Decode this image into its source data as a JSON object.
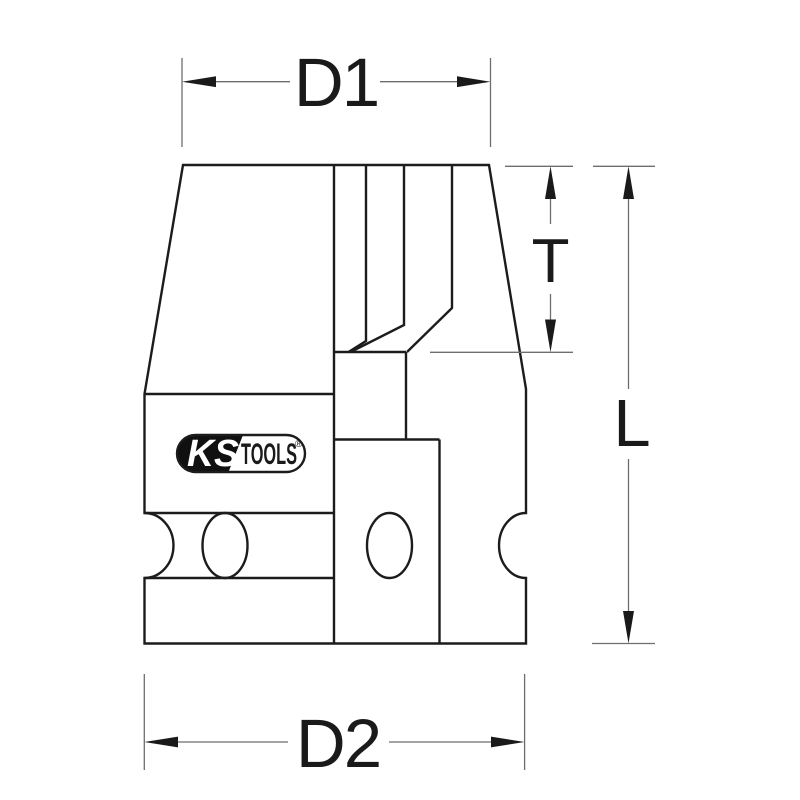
{
  "labels": {
    "d1": "D1",
    "d2": "D2",
    "t": "T",
    "l": "L"
  },
  "logo": {
    "ks": "KS",
    "tools": "TOOLS",
    "registered": "®"
  },
  "colors": {
    "background": "#ffffff",
    "object_line": "#1c1c1c",
    "dimension_line": "#6e6e6e",
    "ink": "#1a1a1a",
    "logo_fill": "#101010",
    "logo_text_light": "#ffffff"
  }
}
